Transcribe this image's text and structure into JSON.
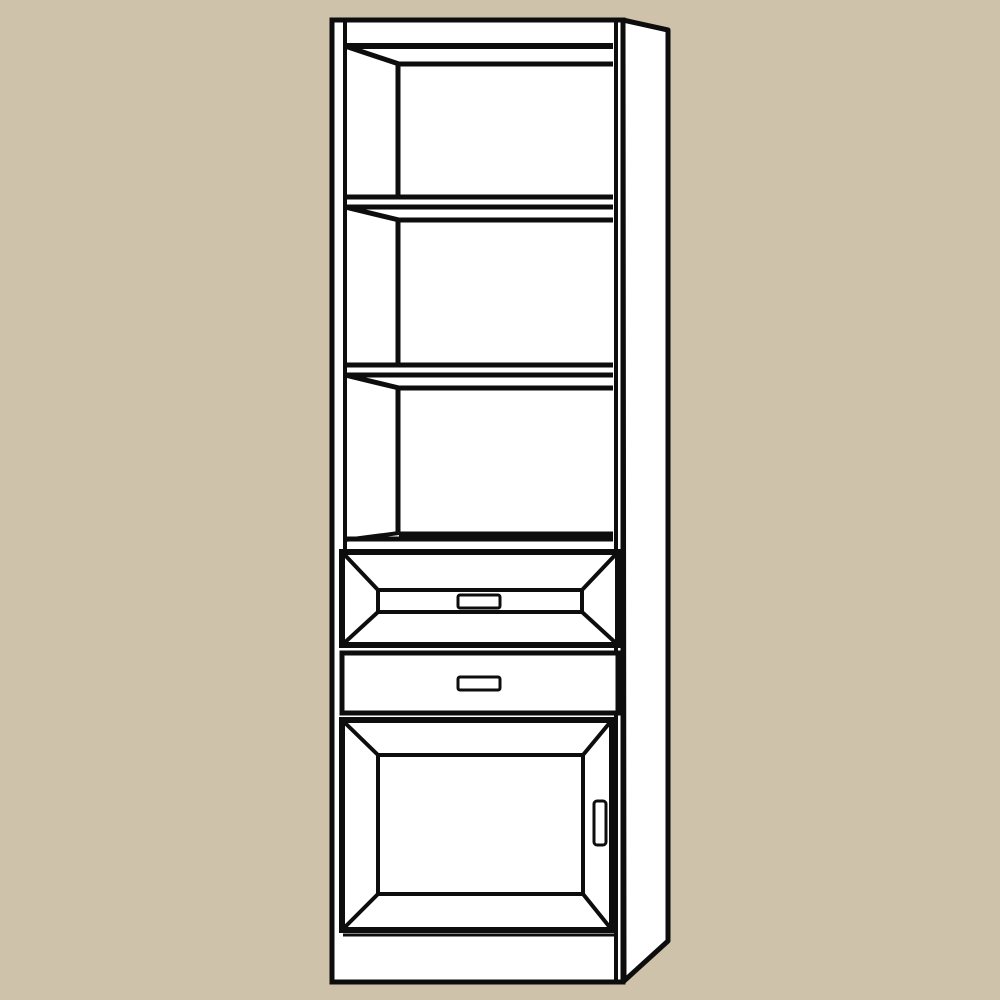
{
  "scene": {
    "label": "Black-and-white line drawing of a tall bookcase cabinet with three open shelves on top, two drawers in the middle and a panelled door at the bottom, shown in slight right-side perspective on a tan background",
    "type": "furniture-illustration"
  },
  "colors": {
    "background": "#cec2ab",
    "line": "#0d0d0d",
    "surface": "#ffffff"
  },
  "furniture": {
    "open_shelves": 3,
    "drawers": 2,
    "doors": 1,
    "drawer_handles": 2,
    "door_handles": 1,
    "has_plinth": true,
    "has_side_panel": true
  }
}
